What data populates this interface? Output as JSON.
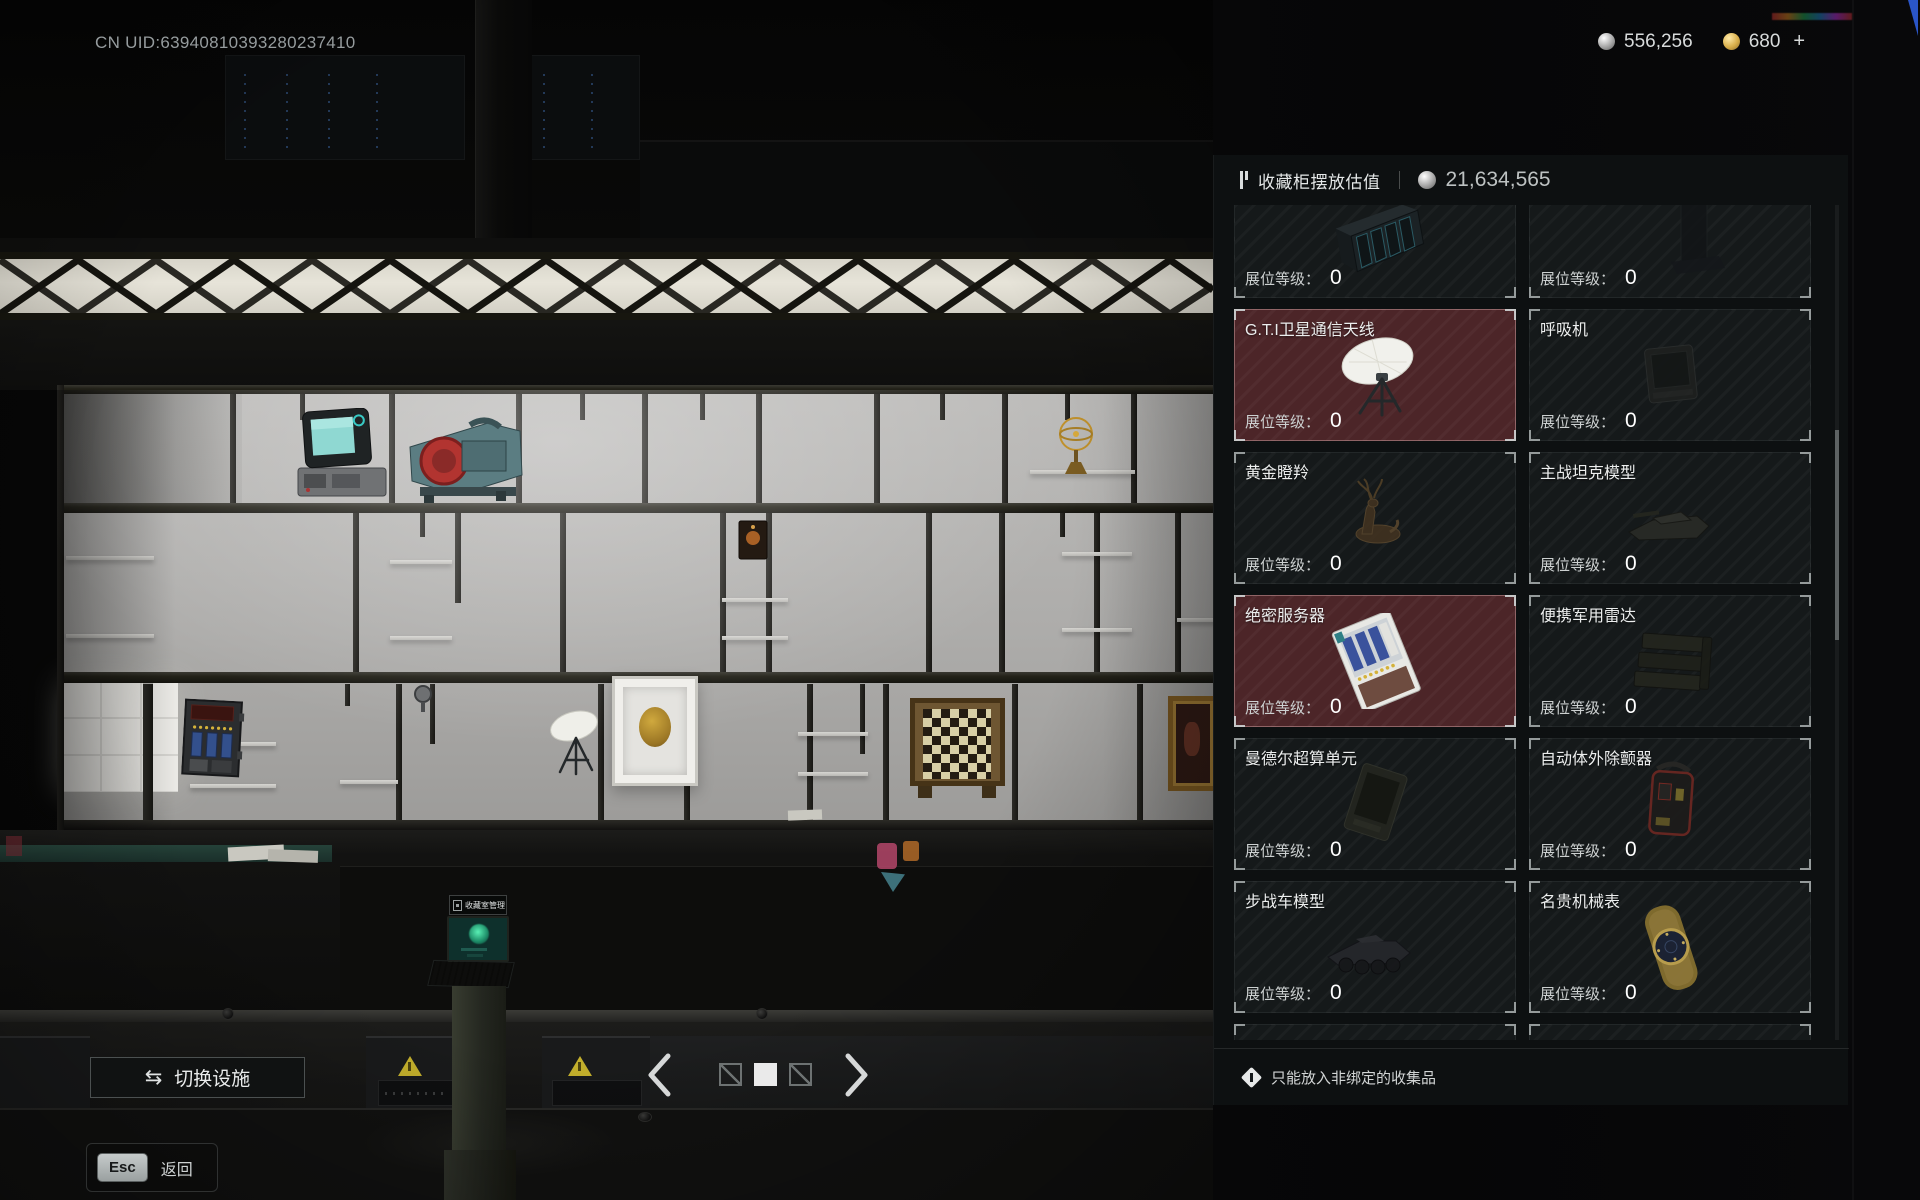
{
  "top_bar": {
    "uid": "CN UID:63940810393280237410",
    "currencies": [
      {
        "icon": "silver-coin",
        "value": "556,256",
        "suffix": ""
      },
      {
        "icon": "gold-coin",
        "value": "680",
        "suffix": "+"
      }
    ]
  },
  "panel": {
    "title": "收藏柜摆放估值",
    "value_icon": "silver-coin",
    "total_value": "21,634,565",
    "slot_level_label": "展位等级：",
    "footer_note": "只能放入非绑定的收集品",
    "items": [
      {
        "name": "",
        "level": "0",
        "selected": false,
        "icon": "server-chassis"
      },
      {
        "name": "",
        "level": "0",
        "selected": false,
        "icon": "equipment-rack"
      },
      {
        "name": "G.T.I卫星通信天线",
        "level": "0",
        "selected": true,
        "icon": "satellite-antenna"
      },
      {
        "name": "呼吸机",
        "level": "0",
        "selected": false,
        "icon": "ventilator"
      },
      {
        "name": "黄金瞪羚",
        "level": "0",
        "selected": false,
        "icon": "golden-gazelle"
      },
      {
        "name": "主战坦克模型",
        "level": "0",
        "selected": false,
        "icon": "tank-model"
      },
      {
        "name": "绝密服务器",
        "level": "0",
        "selected": true,
        "icon": "server-tray"
      },
      {
        "name": "便携军用雷达",
        "level": "0",
        "selected": false,
        "icon": "military-radar"
      },
      {
        "name": "曼德尔超算单元",
        "level": "0",
        "selected": false,
        "icon": "compute-unit"
      },
      {
        "name": "自动体外除颤器",
        "level": "0",
        "selected": false,
        "icon": "defibrillator"
      },
      {
        "name": "步战车模型",
        "level": "0",
        "selected": false,
        "icon": "ifv-model"
      },
      {
        "name": "名贵机械表",
        "level": "0",
        "selected": false,
        "icon": "luxury-watch"
      },
      {
        "name": "",
        "level": "",
        "selected": false,
        "icon": ""
      },
      {
        "name": "",
        "level": "",
        "selected": false,
        "icon": ""
      }
    ]
  },
  "scene": {
    "kiosk_tooltip": "收藏室管理"
  },
  "bottom_bar": {
    "switch_facility_label": "切换设施",
    "esc_key": "Esc",
    "back_label": "返回"
  }
}
